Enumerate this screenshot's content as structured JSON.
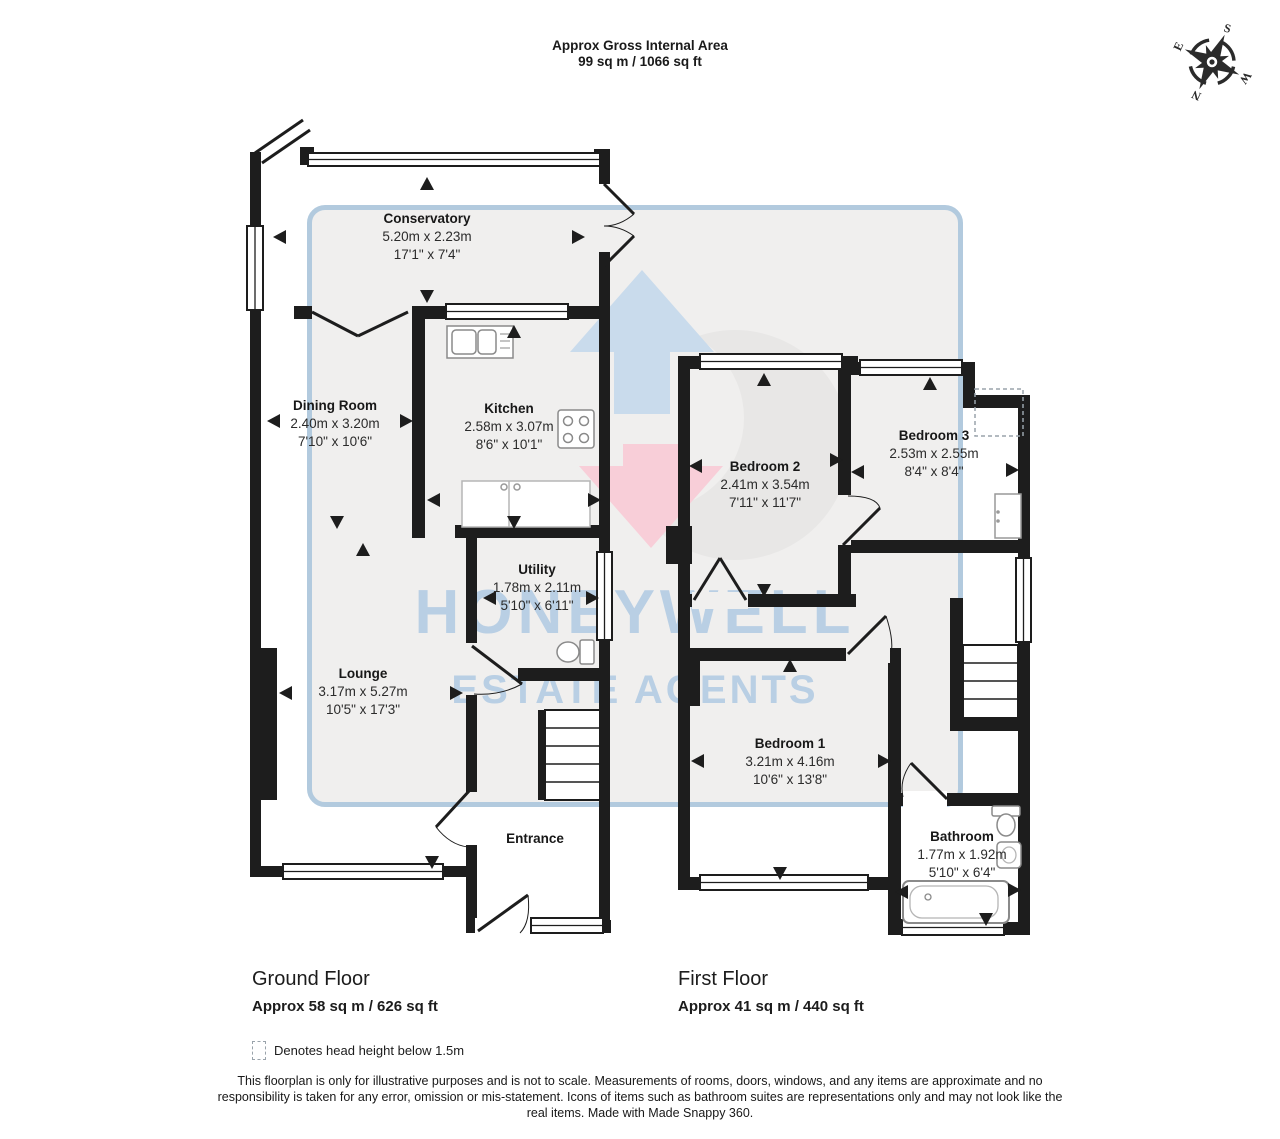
{
  "header": {
    "title": "Approx Gross Internal Area",
    "subtitle": "99 sq m / 1066 sq ft"
  },
  "compass": {
    "n": "N",
    "e": "E",
    "s": "S",
    "w": "W"
  },
  "watermark": {
    "line1": "HONEYWELL",
    "line2": "ESTATE AGENTS",
    "text_color": "#b9cfe4",
    "panel_border_color": "#b2cade",
    "panel_fill_color": "#f0efee",
    "logo_arrow_up_color": "#c9dbec",
    "logo_arrow_down_color": "#f8ced8"
  },
  "floors": [
    {
      "name": "Ground Floor",
      "area": "Approx 58 sq m / 626 sq ft",
      "rooms": [
        {
          "name": "Conservatory",
          "metric": "5.20m x 2.23m",
          "imperial": "17'1\" x 7'4\""
        },
        {
          "name": "Dining Room",
          "metric": "2.40m x 3.20m",
          "imperial": "7'10\" x 10'6\""
        },
        {
          "name": "Kitchen",
          "metric": "2.58m x 3.07m",
          "imperial": "8'6\" x 10'1\""
        },
        {
          "name": "Utility",
          "metric": "1.78m x 2.11m",
          "imperial": "5'10\" x 6'11\""
        },
        {
          "name": "Lounge",
          "metric": "3.17m x 5.27m",
          "imperial": "10'5\" x 17'3\""
        },
        {
          "name": "Entrance"
        }
      ]
    },
    {
      "name": "First Floor",
      "area": "Approx 41 sq m / 440 sq ft",
      "rooms": [
        {
          "name": "Bedroom 2",
          "metric": "2.41m x 3.54m",
          "imperial": "7'11\" x 11'7\""
        },
        {
          "name": "Bedroom 3",
          "metric": "2.53m x 2.55m",
          "imperial": "8'4\" x 8'4\""
        },
        {
          "name": "Bedroom 1",
          "metric": "3.21m x 4.16m",
          "imperial": "10'6\" x 13'8\""
        },
        {
          "name": "Bathroom",
          "metric": "1.77m x 1.92m",
          "imperial": "5'10\" x 6'4\""
        }
      ]
    }
  ],
  "legend": {
    "text": "Denotes head height below 1.5m"
  },
  "disclaimer": "This floorplan is only for illustrative purposes and is not to scale. Measurements of rooms, doors, windows, and any items are approximate and no responsibility is taken for any error, omission or mis-statement. Icons of items such as bathroom suites are representations only and may not look like the real items. Made with Made Snappy 360.",
  "icons": {
    "compass": "compass-rose",
    "sink": "kitchen-sink",
    "hob": "cooker-hob",
    "toilet": "toilet",
    "bath": "bathtub",
    "stairs": "staircase"
  }
}
